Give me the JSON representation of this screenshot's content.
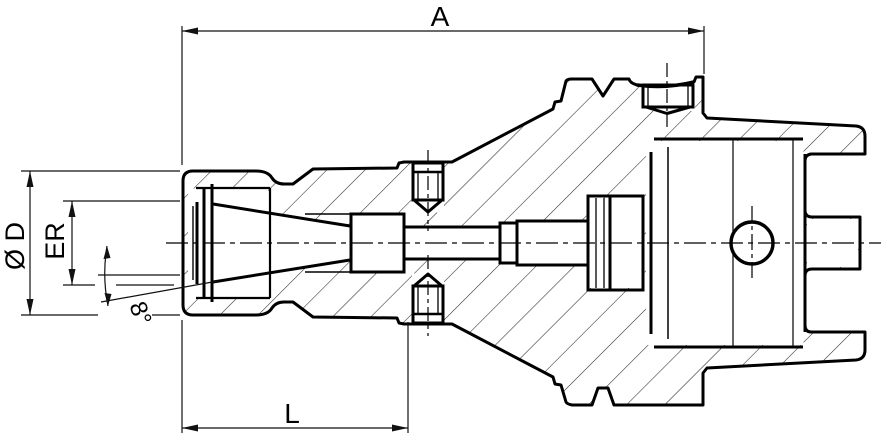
{
  "drawing": {
    "kind": "technical-section-drawing",
    "subject": "collet-chuck-with-hollow-taper-shank",
    "colors": {
      "line": "#000000",
      "hatch": "#2a2a2a",
      "background": "#ffffff"
    },
    "labels": {
      "overall_length": "A",
      "body_diameter": "Ø D",
      "collet_size": "ER",
      "taper_angle": "8°",
      "nose_length": "L"
    }
  }
}
